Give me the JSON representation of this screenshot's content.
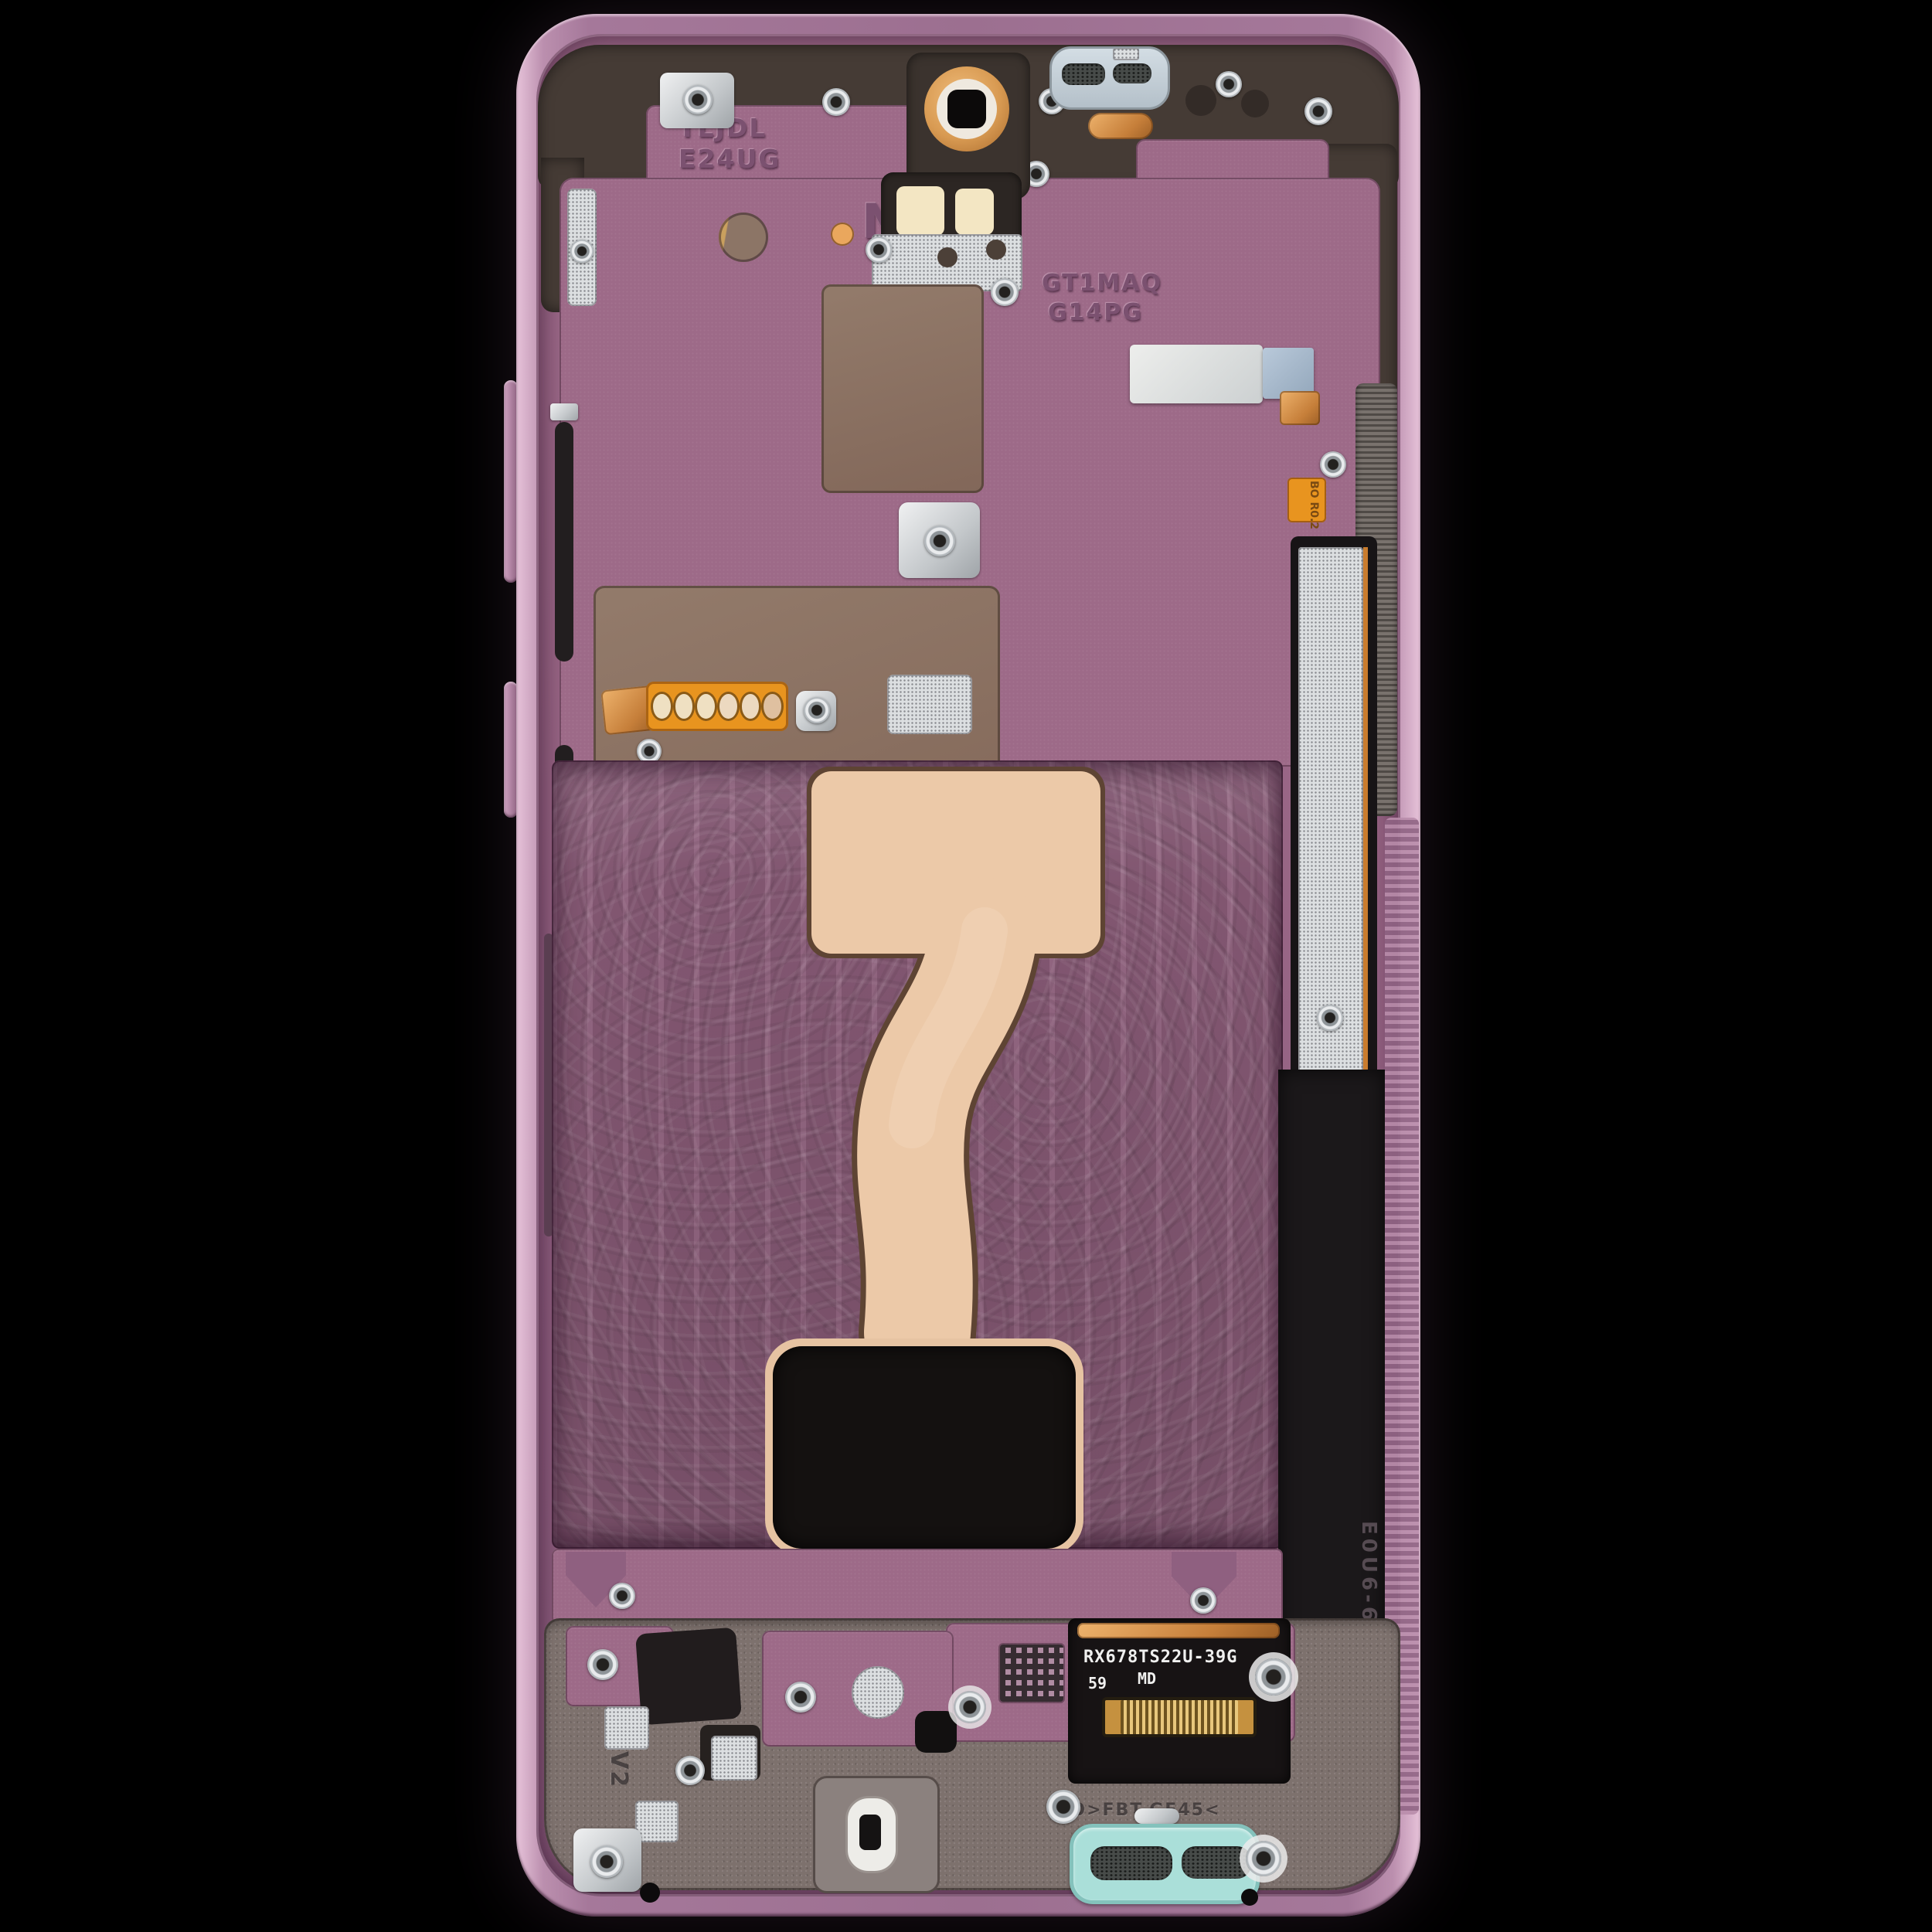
{
  "subject_markings": {
    "chip_line1": "TLJDL",
    "chip_line2": "E24UG",
    "nfc_letter": "N",
    "mid_line1": "GT1MAQ",
    "mid_line2": "G14PG",
    "flex_model": "RX678TS22U-39G",
    "flex_num": "59",
    "flex_md": "MD",
    "resin_bottom": "BO>FBT-GF45<",
    "right_vert_1": "E0U6-6",
    "right_vert_2": "PA-GF50",
    "right_arrow": "◀",
    "left_vert": "V2",
    "small_flex": "BO R0.2"
  },
  "colors": {
    "background": "#000000",
    "frame_pink": "#c9a2be",
    "chassis_purple": "#9b6886",
    "ribbed_purple": "#8b5c79",
    "dark_plastic": "#453b35",
    "taupe_patch": "#8a7263",
    "flex_cream": "#ecc9a8",
    "copper": "#cf8a42",
    "flash_window_cream": "#f3e6c3",
    "earpiece_gray": "#c6d1d9",
    "speaker_teal": "#aadfd9",
    "flex_orange": "#e8941f",
    "screw_silver": "#d9dcde",
    "label_black": "#171314",
    "stiffener_white": "#dde1e3"
  }
}
